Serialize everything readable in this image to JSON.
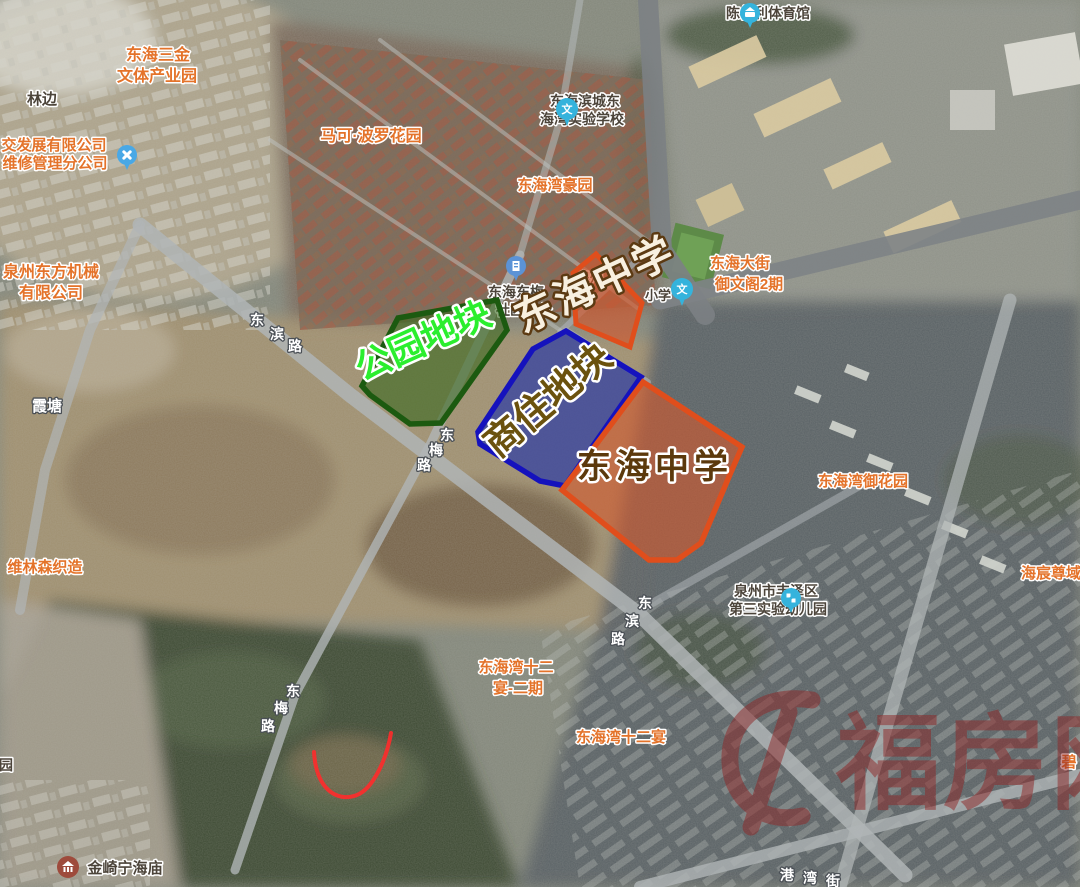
{
  "map_overlay": {
    "parcels": [
      {
        "id": "park",
        "label": "公园地块",
        "fill": "#34661a",
        "fill_opacity": "0.58",
        "border": "#1c5a10",
        "label_color": "#2bee2e"
      },
      {
        "id": "commercial-residential",
        "label": "商住地块",
        "fill": "#2b3aa5",
        "fill_opacity": "0.70",
        "border": "#1512bd",
        "label_color": "#6b520e"
      },
      {
        "id": "school-upper",
        "label": "东海中学",
        "fill": "#d2582d",
        "fill_opacity": "0.66",
        "border": "#e04e1c",
        "label_color": "#f8f0e0"
      },
      {
        "id": "school-lower",
        "label": "东海中学",
        "fill": "#d2582d",
        "fill_opacity": "0.62",
        "border": "#e04e1c",
        "label_color": "#5c390c"
      }
    ],
    "watermark": {
      "text": "福房网",
      "color": "#8f2626"
    },
    "annotation_curve_color": "#ff2b2b"
  },
  "poi_labels": [
    {
      "id": "donghai-sanjin",
      "lines": [
        "东海三金",
        "文体产业园"
      ],
      "style": "orange"
    },
    {
      "id": "linbian",
      "lines": [
        "林边"
      ],
      "style": "dark"
    },
    {
      "id": "jiaofazhan-repair",
      "lines": [
        "交发展有限公司",
        "维修管理分公司"
      ],
      "style": "orange"
    },
    {
      "id": "quanzhou-dongfang",
      "lines": [
        "泉州东方机械",
        "有限公司"
      ],
      "style": "orange"
    },
    {
      "id": "marco-polo-garden",
      "lines": [
        "马可·波罗花园"
      ],
      "style": "orange"
    },
    {
      "id": "bincheng-school",
      "lines": [
        "东海滨城东",
        "海湾实验学校"
      ],
      "style": "dark"
    },
    {
      "id": "donghaiwan-haoyuan",
      "lines": [
        "东海湾豪园"
      ],
      "style": "orange"
    },
    {
      "id": "chenweili-gym",
      "lines": [
        "陈伟利体育馆"
      ],
      "style": "dark"
    },
    {
      "id": "donghai-dajie-yuwenge",
      "lines": [
        "东海大街",
        "御文阁2期"
      ],
      "style": "orange"
    },
    {
      "id": "donghai-dongmei",
      "lines": [
        "东海东梅",
        "社区办公"
      ],
      "style": "dark"
    },
    {
      "id": "fragment-quanzhou",
      "lines": [
        "泉州"
      ],
      "style": "dark"
    },
    {
      "id": "fragment-xiaoxue",
      "lines": [
        "小学"
      ],
      "style": "dark"
    },
    {
      "id": "xiatang",
      "lines": [
        "霞塘"
      ],
      "style": "white"
    },
    {
      "id": "weilinsen",
      "lines": [
        "维林森织造"
      ],
      "style": "orange"
    },
    {
      "id": "fengze-kindergarten",
      "lines": [
        "泉州市丰泽区",
        "第三实验幼儿园"
      ],
      "style": "dark"
    },
    {
      "id": "shieryan-phase2",
      "lines": [
        "东海湾十二",
        "宴-二期"
      ],
      "style": "orange"
    },
    {
      "id": "shieryan",
      "lines": [
        "东海湾十二宴"
      ],
      "style": "orange"
    },
    {
      "id": "yuhuayuan",
      "lines": [
        "东海湾御花园"
      ],
      "style": "orange"
    },
    {
      "id": "haichen-zunyu",
      "lines": [
        "海宸尊域"
      ],
      "style": "orange"
    },
    {
      "id": "jinqi-temple",
      "lines": [
        "金崎宁海庙"
      ],
      "style": "dark"
    },
    {
      "id": "fragment-yuan",
      "lines": [
        "园"
      ],
      "style": "dark"
    },
    {
      "id": "fragment-bi",
      "lines": [
        "碧"
      ],
      "style": "orange"
    }
  ],
  "road_labels": [
    {
      "id": "dongbin-road-nw",
      "text": "东滨路"
    },
    {
      "id": "dongmei-road-mid",
      "text": "东梅路"
    },
    {
      "id": "dongbin-road-se",
      "text": "东滨路"
    },
    {
      "id": "dongmei-road-s",
      "text": "东梅路"
    },
    {
      "id": "gangwan-street",
      "text": "港湾街"
    }
  ],
  "pin_glyphs": {
    "wen": "文"
  }
}
